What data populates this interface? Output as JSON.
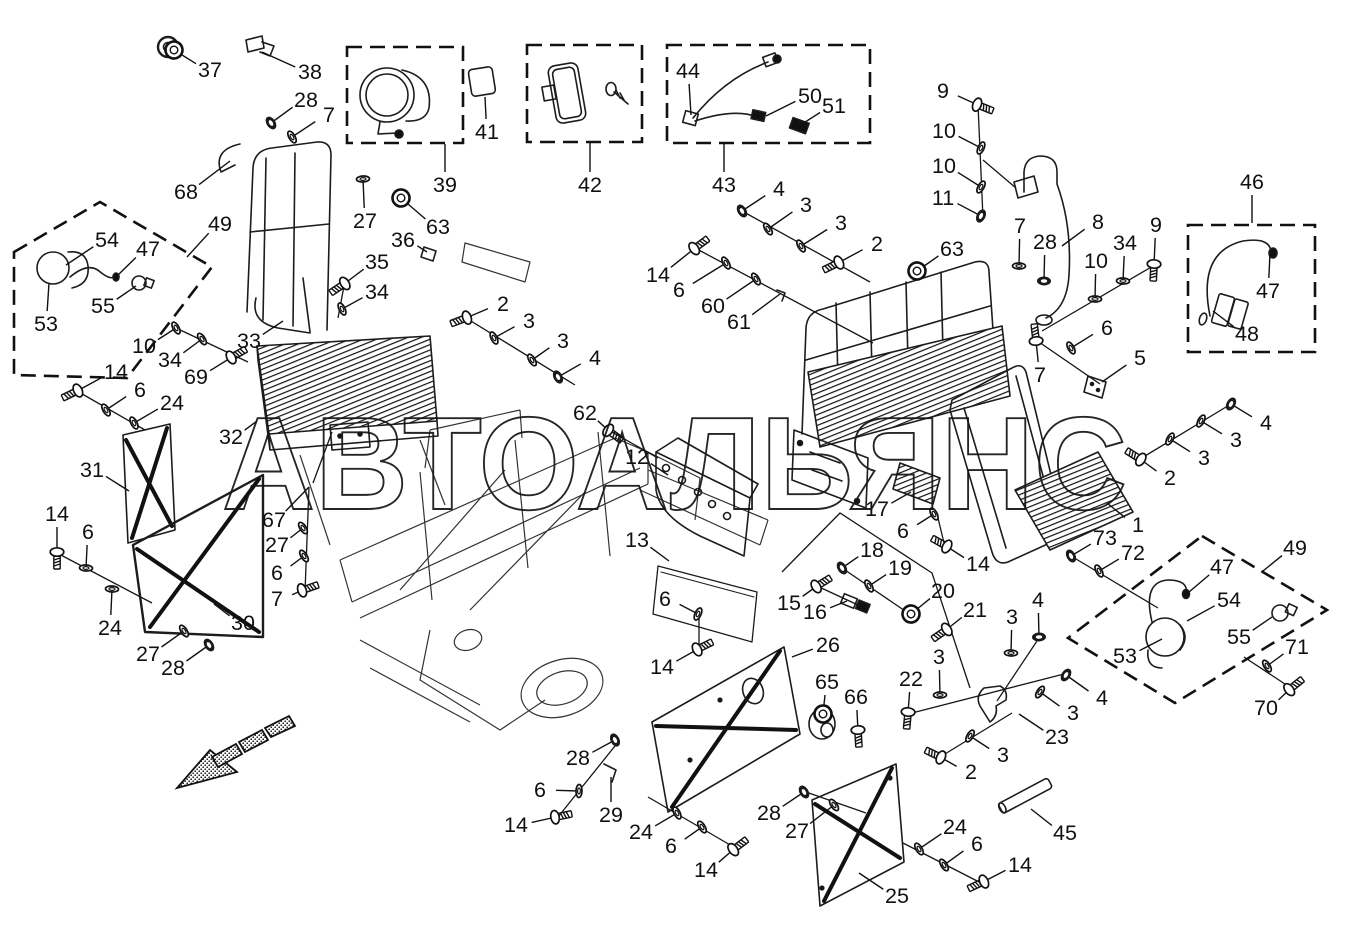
{
  "watermark": "АВТОАЛЬЯНС",
  "callouts": [
    {
      "t": "37",
      "x": 210,
      "y": 70,
      "lx": 174,
      "ly": 50,
      "g": "grommet"
    },
    {
      "t": "38",
      "x": 310,
      "y": 72,
      "lx": 262,
      "ly": 52,
      "g": "none"
    },
    {
      "t": "28",
      "x": 306,
      "y": 100,
      "lx": 271,
      "ly": 123,
      "g": "nut"
    },
    {
      "t": "7",
      "x": 329,
      "y": 115,
      "lx": 292,
      "ly": 137,
      "g": "washer"
    },
    {
      "t": "68",
      "x": 186,
      "y": 192,
      "lx": 230,
      "ly": 161,
      "g": "none"
    },
    {
      "t": "27",
      "x": 365,
      "y": 221,
      "lx": 363,
      "ly": 179,
      "g": "washer"
    },
    {
      "t": "63",
      "x": 438,
      "y": 227,
      "lx": 401,
      "ly": 198,
      "g": "grommet"
    },
    {
      "t": "36",
      "x": 403,
      "y": 240,
      "lx": 427,
      "ly": 252,
      "g": "none"
    },
    {
      "t": "35",
      "x": 377,
      "y": 262,
      "lx": 344,
      "ly": 284,
      "g": "bolt"
    },
    {
      "t": "34",
      "x": 377,
      "y": 292,
      "lx": 342,
      "ly": 309,
      "g": "washer"
    },
    {
      "t": "39",
      "x": 445,
      "y": 185,
      "lx": 445,
      "ly": 144,
      "g": "none"
    },
    {
      "t": "41",
      "x": 487,
      "y": 132,
      "lx": 485,
      "ly": 97,
      "g": "none"
    },
    {
      "t": "42",
      "x": 590,
      "y": 185,
      "lx": 590,
      "ly": 143,
      "g": "none"
    },
    {
      "t": "43",
      "x": 724,
      "y": 185,
      "lx": 724,
      "ly": 144,
      "g": "none"
    },
    {
      "t": "44",
      "x": 688,
      "y": 71,
      "lx": 691,
      "ly": 115,
      "g": "none"
    },
    {
      "t": "50",
      "x": 810,
      "y": 96,
      "lx": 766,
      "ly": 116,
      "g": "none"
    },
    {
      "t": "51",
      "x": 834,
      "y": 106,
      "lx": 799,
      "ly": 126,
      "g": "none"
    },
    {
      "t": "49",
      "x": 220,
      "y": 224,
      "lx": 187,
      "ly": 257,
      "g": "none"
    },
    {
      "t": "54",
      "x": 107,
      "y": 240,
      "lx": 66,
      "ly": 265,
      "g": "none"
    },
    {
      "t": "47",
      "x": 148,
      "y": 249,
      "lx": 118,
      "ly": 275,
      "g": "none"
    },
    {
      "t": "55",
      "x": 103,
      "y": 306,
      "lx": 136,
      "ly": 286,
      "g": "none"
    },
    {
      "t": "53",
      "x": 46,
      "y": 324,
      "lx": 49,
      "ly": 283,
      "g": "none"
    },
    {
      "t": "10",
      "x": 144,
      "y": 346,
      "lx": 176,
      "ly": 328,
      "g": "washer"
    },
    {
      "t": "34",
      "x": 170,
      "y": 360,
      "lx": 202,
      "ly": 339,
      "g": "washer"
    },
    {
      "t": "69",
      "x": 196,
      "y": 377,
      "lx": 232,
      "ly": 357,
      "g": "bolt"
    },
    {
      "t": "33",
      "x": 249,
      "y": 341,
      "lx": 283,
      "ly": 321,
      "g": "none"
    },
    {
      "t": "14",
      "x": 116,
      "y": 372,
      "lx": 77,
      "ly": 391,
      "g": "bolt"
    },
    {
      "t": "6",
      "x": 140,
      "y": 390,
      "lx": 106,
      "ly": 410,
      "g": "washer"
    },
    {
      "t": "24",
      "x": 172,
      "y": 403,
      "lx": 134,
      "ly": 423,
      "g": "washer"
    },
    {
      "t": "31",
      "x": 92,
      "y": 470,
      "lx": 129,
      "ly": 491,
      "g": "none"
    },
    {
      "t": "32",
      "x": 231,
      "y": 437,
      "lx": 257,
      "ly": 421,
      "g": "none"
    },
    {
      "t": "14",
      "x": 57,
      "y": 514,
      "lx": 57,
      "ly": 553,
      "g": "bolt"
    },
    {
      "t": "6",
      "x": 88,
      "y": 532,
      "lx": 86,
      "ly": 568,
      "g": "washer"
    },
    {
      "t": "24",
      "x": 110,
      "y": 628,
      "lx": 112,
      "ly": 589,
      "g": "washer"
    },
    {
      "t": "30",
      "x": 243,
      "y": 623,
      "lx": 214,
      "ly": 604,
      "g": "none"
    },
    {
      "t": "27",
      "x": 148,
      "y": 654,
      "lx": 184,
      "ly": 631,
      "g": "washer"
    },
    {
      "t": "28",
      "x": 173,
      "y": 668,
      "lx": 209,
      "ly": 645,
      "g": "nut"
    },
    {
      "t": "67",
      "x": 274,
      "y": 520,
      "lx": 309,
      "ly": 487,
      "g": "none"
    },
    {
      "t": "27",
      "x": 277,
      "y": 545,
      "lx": 303,
      "ly": 528,
      "g": "washer"
    },
    {
      "t": "6",
      "x": 277,
      "y": 573,
      "lx": 304,
      "ly": 556,
      "g": "washer"
    },
    {
      "t": "7",
      "x": 277,
      "y": 599,
      "lx": 303,
      "ly": 590,
      "g": "bolt"
    },
    {
      "t": "2",
      "x": 503,
      "y": 304,
      "lx": 466,
      "ly": 318,
      "g": "bolt"
    },
    {
      "t": "3",
      "x": 529,
      "y": 321,
      "lx": 494,
      "ly": 338,
      "g": "washer"
    },
    {
      "t": "3",
      "x": 563,
      "y": 341,
      "lx": 532,
      "ly": 360,
      "g": "washer"
    },
    {
      "t": "4",
      "x": 595,
      "y": 358,
      "lx": 558,
      "ly": 377,
      "g": "nut"
    },
    {
      "t": "62",
      "x": 585,
      "y": 413,
      "lx": 609,
      "ly": 431,
      "g": "bolt"
    },
    {
      "t": "12",
      "x": 637,
      "y": 457,
      "lx": 668,
      "ly": 475,
      "g": "none"
    },
    {
      "t": "13",
      "x": 637,
      "y": 540,
      "lx": 669,
      "ly": 561,
      "g": "none"
    },
    {
      "t": "6",
      "x": 665,
      "y": 599,
      "lx": 698,
      "ly": 614,
      "g": "washer"
    },
    {
      "t": "14",
      "x": 662,
      "y": 667,
      "lx": 698,
      "ly": 649,
      "g": "bolt"
    },
    {
      "t": "4",
      "x": 779,
      "y": 189,
      "lx": 742,
      "ly": 211,
      "g": "nut"
    },
    {
      "t": "3",
      "x": 806,
      "y": 205,
      "lx": 768,
      "ly": 229,
      "g": "washer"
    },
    {
      "t": "3",
      "x": 841,
      "y": 223,
      "lx": 801,
      "ly": 246,
      "g": "washer"
    },
    {
      "t": "2",
      "x": 877,
      "y": 244,
      "lx": 838,
      "ly": 263,
      "g": "bolt"
    },
    {
      "t": "14",
      "x": 658,
      "y": 275,
      "lx": 695,
      "ly": 248,
      "g": "bolt"
    },
    {
      "t": "6",
      "x": 679,
      "y": 290,
      "lx": 726,
      "ly": 263,
      "g": "washer"
    },
    {
      "t": "60",
      "x": 713,
      "y": 306,
      "lx": 756,
      "ly": 279,
      "g": "washer"
    },
    {
      "t": "61",
      "x": 739,
      "y": 322,
      "lx": 780,
      "ly": 294,
      "g": "none"
    },
    {
      "t": "63",
      "x": 952,
      "y": 249,
      "lx": 917,
      "ly": 271,
      "g": "grommet"
    },
    {
      "t": "9",
      "x": 943,
      "y": 91,
      "lx": 978,
      "ly": 105,
      "g": "bolt"
    },
    {
      "t": "10",
      "x": 944,
      "y": 131,
      "lx": 981,
      "ly": 148,
      "g": "washer"
    },
    {
      "t": "10",
      "x": 944,
      "y": 166,
      "lx": 981,
      "ly": 187,
      "g": "washer"
    },
    {
      "t": "11",
      "x": 943,
      "y": 198,
      "lx": 981,
      "ly": 216,
      "g": "nut"
    },
    {
      "t": "8",
      "x": 1098,
      "y": 222,
      "lx": 1062,
      "ly": 246,
      "g": "none"
    },
    {
      "t": "7",
      "x": 1020,
      "y": 226,
      "lx": 1019,
      "ly": 266,
      "g": "washer"
    },
    {
      "t": "28",
      "x": 1045,
      "y": 242,
      "lx": 1044,
      "ly": 281,
      "g": "nut"
    },
    {
      "t": "34",
      "x": 1125,
      "y": 243,
      "lx": 1123,
      "ly": 281,
      "g": "washer"
    },
    {
      "t": "9",
      "x": 1156,
      "y": 225,
      "lx": 1154,
      "ly": 265,
      "g": "bolt"
    },
    {
      "t": "10",
      "x": 1096,
      "y": 261,
      "lx": 1095,
      "ly": 299,
      "g": "washer"
    },
    {
      "t": "6",
      "x": 1107,
      "y": 328,
      "lx": 1071,
      "ly": 348,
      "g": "washer"
    },
    {
      "t": "5",
      "x": 1140,
      "y": 358,
      "lx": 1102,
      "ly": 382,
      "g": "none"
    },
    {
      "t": "7",
      "x": 1040,
      "y": 375,
      "lx": 1036,
      "ly": 340,
      "g": "bolt"
    },
    {
      "t": "46",
      "x": 1252,
      "y": 182,
      "lx": 1252,
      "ly": 223,
      "g": "none"
    },
    {
      "t": "47",
      "x": 1268,
      "y": 291,
      "lx": 1270,
      "ly": 253,
      "g": "none"
    },
    {
      "t": "48",
      "x": 1247,
      "y": 334,
      "lx": 1213,
      "ly": 311,
      "g": "none"
    },
    {
      "t": "4",
      "x": 1266,
      "y": 423,
      "lx": 1231,
      "ly": 404,
      "g": "nut"
    },
    {
      "t": "3",
      "x": 1236,
      "y": 440,
      "lx": 1201,
      "ly": 421,
      "g": "washer"
    },
    {
      "t": "3",
      "x": 1204,
      "y": 458,
      "lx": 1170,
      "ly": 439,
      "g": "washer"
    },
    {
      "t": "2",
      "x": 1170,
      "y": 478,
      "lx": 1140,
      "ly": 459,
      "g": "bolt"
    },
    {
      "t": "1",
      "x": 1138,
      "y": 525,
      "lx": 1107,
      "ly": 503,
      "g": "none"
    },
    {
      "t": "73",
      "x": 1105,
      "y": 538,
      "lx": 1071,
      "ly": 556,
      "g": "nut"
    },
    {
      "t": "72",
      "x": 1133,
      "y": 553,
      "lx": 1099,
      "ly": 571,
      "g": "washer"
    },
    {
      "t": "49",
      "x": 1295,
      "y": 548,
      "lx": 1263,
      "ly": 571,
      "g": "none"
    },
    {
      "t": "47",
      "x": 1222,
      "y": 567,
      "lx": 1189,
      "ly": 592,
      "g": "none"
    },
    {
      "t": "54",
      "x": 1229,
      "y": 600,
      "lx": 1187,
      "ly": 621,
      "g": "none"
    },
    {
      "t": "55",
      "x": 1239,
      "y": 637,
      "lx": 1272,
      "ly": 617,
      "g": "none"
    },
    {
      "t": "53",
      "x": 1125,
      "y": 656,
      "lx": 1162,
      "ly": 639,
      "g": "none"
    },
    {
      "t": "71",
      "x": 1297,
      "y": 647,
      "lx": 1267,
      "ly": 666,
      "g": "washer"
    },
    {
      "t": "70",
      "x": 1266,
      "y": 708,
      "lx": 1290,
      "ly": 689,
      "g": "bolt"
    },
    {
      "t": "17",
      "x": 877,
      "y": 509,
      "lx": 911,
      "ly": 492,
      "g": "none"
    },
    {
      "t": "6",
      "x": 903,
      "y": 531,
      "lx": 934,
      "ly": 514,
      "g": "washer"
    },
    {
      "t": "14",
      "x": 978,
      "y": 564,
      "lx": 946,
      "ly": 546,
      "g": "bolt"
    },
    {
      "t": "18",
      "x": 872,
      "y": 550,
      "lx": 842,
      "ly": 568,
      "g": "nut"
    },
    {
      "t": "19",
      "x": 900,
      "y": 568,
      "lx": 869,
      "ly": 586,
      "g": "washer"
    },
    {
      "t": "20",
      "x": 943,
      "y": 591,
      "lx": 911,
      "ly": 614,
      "g": "grommet"
    },
    {
      "t": "21",
      "x": 975,
      "y": 610,
      "lx": 946,
      "ly": 630,
      "g": "bolt"
    },
    {
      "t": "15",
      "x": 789,
      "y": 603,
      "lx": 817,
      "ly": 586,
      "g": "bolt"
    },
    {
      "t": "16",
      "x": 815,
      "y": 612,
      "lx": 847,
      "ly": 601,
      "g": "none"
    },
    {
      "t": "26",
      "x": 828,
      "y": 645,
      "lx": 792,
      "ly": 657,
      "g": "none"
    },
    {
      "t": "65",
      "x": 827,
      "y": 682,
      "lx": 823,
      "ly": 714,
      "g": "grommet"
    },
    {
      "t": "66",
      "x": 856,
      "y": 697,
      "lx": 858,
      "ly": 731,
      "g": "bolt"
    },
    {
      "t": "22",
      "x": 911,
      "y": 679,
      "lx": 908,
      "ly": 713,
      "g": "bolt"
    },
    {
      "t": "3",
      "x": 939,
      "y": 657,
      "lx": 940,
      "ly": 695,
      "g": "washer"
    },
    {
      "t": "3",
      "x": 1012,
      "y": 617,
      "lx": 1011,
      "ly": 653,
      "g": "washer"
    },
    {
      "t": "4",
      "x": 1038,
      "y": 600,
      "lx": 1039,
      "ly": 637,
      "g": "nut"
    },
    {
      "t": "4",
      "x": 1102,
      "y": 698,
      "lx": 1066,
      "ly": 675,
      "g": "nut"
    },
    {
      "t": "3",
      "x": 1073,
      "y": 713,
      "lx": 1040,
      "ly": 692,
      "g": "washer"
    },
    {
      "t": "23",
      "x": 1057,
      "y": 737,
      "lx": 1019,
      "ly": 714,
      "g": "none"
    },
    {
      "t": "3",
      "x": 1003,
      "y": 755,
      "lx": 970,
      "ly": 736,
      "g": "washer"
    },
    {
      "t": "2",
      "x": 971,
      "y": 772,
      "lx": 940,
      "ly": 757,
      "g": "bolt"
    },
    {
      "t": "28",
      "x": 578,
      "y": 758,
      "lx": 615,
      "ly": 740,
      "g": "nut"
    },
    {
      "t": "6",
      "x": 540,
      "y": 790,
      "lx": 579,
      "ly": 791,
      "g": "washer"
    },
    {
      "t": "14",
      "x": 516,
      "y": 825,
      "lx": 556,
      "ly": 817,
      "g": "bolt"
    },
    {
      "t": "29",
      "x": 611,
      "y": 815,
      "lx": 611,
      "ly": 777,
      "g": "none"
    },
    {
      "t": "24",
      "x": 641,
      "y": 832,
      "lx": 677,
      "ly": 813,
      "g": "washer"
    },
    {
      "t": "6",
      "x": 671,
      "y": 846,
      "lx": 702,
      "ly": 827,
      "g": "washer"
    },
    {
      "t": "14",
      "x": 706,
      "y": 870,
      "lx": 734,
      "ly": 849,
      "g": "bolt"
    },
    {
      "t": "28",
      "x": 769,
      "y": 813,
      "lx": 804,
      "ly": 792,
      "g": "nut"
    },
    {
      "t": "27",
      "x": 797,
      "y": 831,
      "lx": 834,
      "ly": 805,
      "g": "washer"
    },
    {
      "t": "25",
      "x": 897,
      "y": 896,
      "lx": 859,
      "ly": 873,
      "g": "none"
    },
    {
      "t": "24",
      "x": 955,
      "y": 827,
      "lx": 919,
      "ly": 849,
      "g": "washer"
    },
    {
      "t": "6",
      "x": 977,
      "y": 844,
      "lx": 944,
      "ly": 865,
      "g": "washer"
    },
    {
      "t": "14",
      "x": 1020,
      "y": 865,
      "lx": 983,
      "ly": 882,
      "g": "bolt"
    },
    {
      "t": "45",
      "x": 1065,
      "y": 833,
      "lx": 1031,
      "ly": 809,
      "g": "none"
    }
  ]
}
